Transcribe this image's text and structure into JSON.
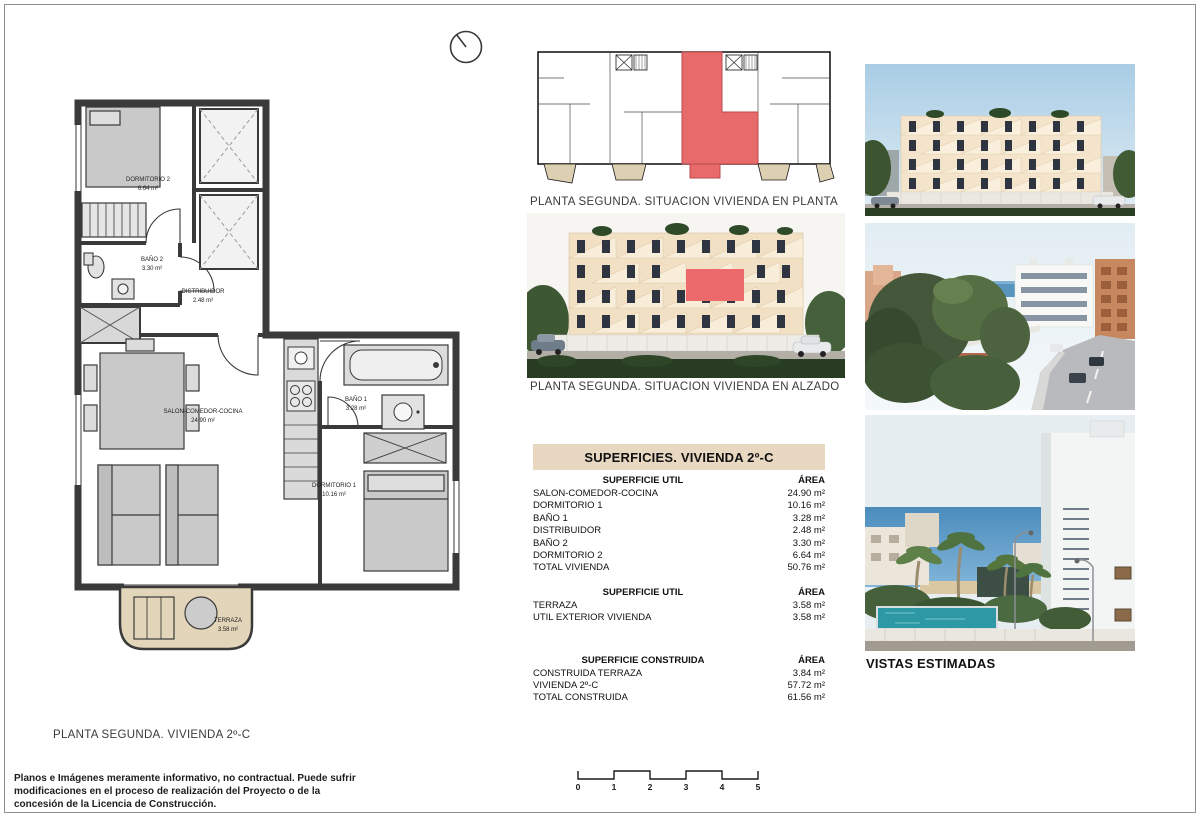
{
  "captions": {
    "floor_plan": "PLANTA SEGUNDA. VIVIENDA 2º-C",
    "situation_plan": "PLANTA SEGUNDA. SITUACION VIVIENDA EN PLANTA",
    "elevation": "PLANTA SEGUNDA. SITUACION VIVIENDA EN ALZADO"
  },
  "floor_plan": {
    "rooms": [
      {
        "name": "DORMITORIO 2",
        "area": "6.64 m²"
      },
      {
        "name": "BAÑO 2",
        "area": "3.30 m²"
      },
      {
        "name": "DISTRIBUIDOR",
        "area": "2.48 m²"
      },
      {
        "name": "SALON-COMEDOR-COCINA",
        "area": "24.90 m²"
      },
      {
        "name": "BAÑO 1",
        "area": "3.28 m²"
      },
      {
        "name": "DORMITORIO 1",
        "area": "10.16 m²"
      },
      {
        "name": "TERRAZA",
        "area": "3.58 m²"
      }
    ]
  },
  "surfaces_table": {
    "title": "SUPERFICIES. VIVIENDA 2º-C",
    "sections": [
      {
        "header": "SUPERFICIE UTIL",
        "area_header": "ÁREA",
        "rows": [
          [
            "SALON-COMEDOR-COCINA",
            "24.90 m²"
          ],
          [
            "DORMITORIO 1",
            "10.16 m²"
          ],
          [
            "BAÑO 1",
            "3.28 m²"
          ],
          [
            "DISTRIBUIDOR",
            "2.48 m²"
          ],
          [
            "BAÑO 2",
            "3.30 m²"
          ],
          [
            "DORMITORIO 2",
            "6.64 m²"
          ],
          [
            "TOTAL VIVIENDA",
            "50.76 m²"
          ]
        ]
      },
      {
        "header": "SUPERFICIE UTIL",
        "area_header": "ÁREA",
        "rows": [
          [
            "TERRAZA",
            "3.58 m²"
          ],
          [
            "UTIL EXTERIOR VIVIENDA",
            "3.58 m²"
          ]
        ]
      },
      {
        "header": "SUPERFICIE CONSTRUIDA",
        "area_header": "ÁREA",
        "rows": [
          [
            "CONSTRUIDA TERRAZA",
            "3.84 m²"
          ],
          [
            "VIVIENDA 2º-C",
            "57.72 m²"
          ],
          [
            "TOTAL CONSTRUIDA",
            "61.56 m²"
          ]
        ]
      }
    ]
  },
  "views": {
    "label": "VISTAS ESTIMADAS"
  },
  "scale_bar": {
    "ticks": [
      "0",
      "1",
      "2",
      "3",
      "4",
      "5"
    ]
  },
  "disclaimer": {
    "text": "Planos e Imágenes meramente informativo, no contractual. Puede sufrir modificaciones en el proceso de realización del Proyecto o de la concesión de la Licencia de Construcción."
  },
  "colors": {
    "highlight_red": "#e96a6b",
    "terrace_tan": "#e3d5b9",
    "table_header_bg": "#e9d8c1"
  }
}
